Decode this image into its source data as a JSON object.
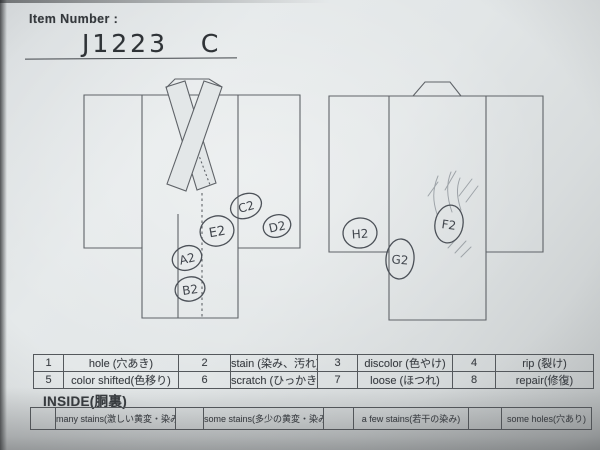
{
  "header": {
    "item_number_label": "Item Number :",
    "item_number_value": "J1223   C"
  },
  "front_view": {
    "marks": [
      "A2",
      "B2",
      "C2",
      "D2",
      "E2"
    ]
  },
  "back_view": {
    "marks": [
      "F2",
      "G2",
      "H2"
    ]
  },
  "defect_table": {
    "rows": [
      [
        "1",
        "hole (穴あき)",
        "2",
        "stain (染み、汚れ)",
        "3",
        "discolor (色やけ)",
        "4",
        "rip (裂け)"
      ],
      [
        "5",
        "color shifted(色移り)",
        "6",
        "scratch (ひっかき傷)",
        "7",
        "loose (ほつれ)",
        "8",
        "repair(修復)"
      ]
    ]
  },
  "inside_section": {
    "label": "INSIDE(胴裏)",
    "cells": [
      "",
      "many stains(激しい黄変・染み)",
      "",
      "some stains(多少の黄変・染み)",
      "",
      "a few stains(若干の染み)",
      "",
      "some holes(穴あり)"
    ]
  },
  "colors": {
    "paper": "#e2e6e7",
    "print_ink": "#3a3e43",
    "pencil_mark": "#4c5158"
  }
}
